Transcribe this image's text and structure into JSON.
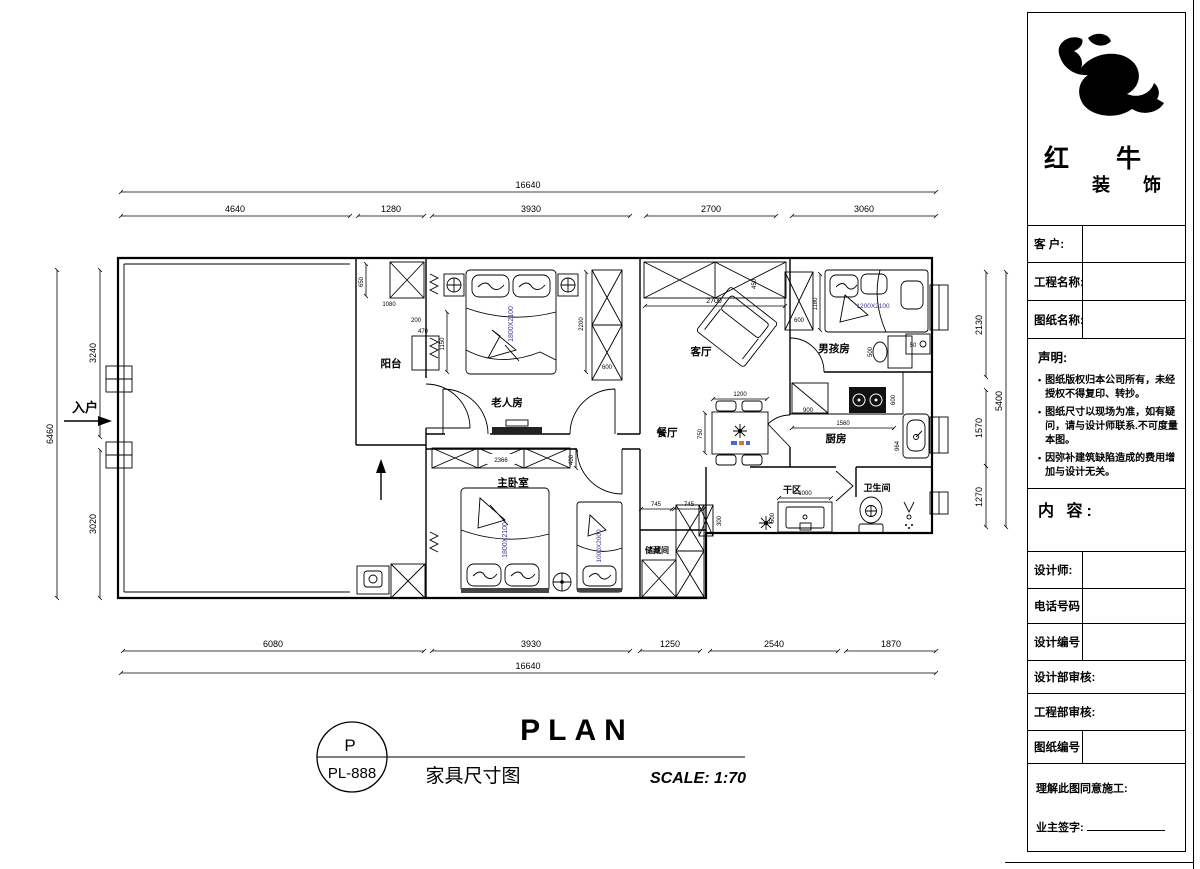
{
  "title_bar": {
    "plan_title": "PLAN",
    "drawing_letter": "P",
    "drawing_code": "PL-888",
    "drawing_name": "家具尺寸图",
    "scale": "SCALE: 1:70"
  },
  "title_block": {
    "brand_line1": "红 牛",
    "brand_line2": "装 饰",
    "info_rows": [
      {
        "label": "客 户:"
      },
      {
        "label": "工程名称:"
      },
      {
        "label": "图纸名称:"
      }
    ],
    "statement": {
      "heading": "声明:",
      "items": [
        "图纸版权归本公司所有，未经授权不得复印、转抄。",
        "图纸尺寸以现场为准，如有疑问，请与设计师联系.不可度量本图。",
        "因弥补建筑缺陷造成的费用增加与设计无关。"
      ]
    },
    "content_heading": "内 容:",
    "detail_rows": [
      {
        "label": "设计师:"
      },
      {
        "label": "电话号码"
      },
      {
        "label": "设计编号"
      },
      {
        "label": "设计部审核:"
      },
      {
        "label": "工程部审核:"
      },
      {
        "label": "图纸编号"
      }
    ],
    "footer": {
      "agree": "理解此图同意施工:",
      "sign": "业主签字:"
    }
  },
  "plan": {
    "rooms": {
      "balcony": "阳台",
      "elder": "老人房",
      "living": "客厅",
      "dining": "餐厅",
      "boy": "男孩房",
      "kitchen": "厨房",
      "master": "主卧室",
      "storage": "储藏间",
      "dry": "干区",
      "bath": "卫生间"
    },
    "entry": "入户",
    "beds": {
      "elder": "1800X2100",
      "master": "1800X2100",
      "single": "1000X2000",
      "boy": "1200X2100"
    },
    "water_heater": "50",
    "dims": {
      "top_overall": "16640",
      "top": [
        "4640",
        "1280",
        "3930",
        "2700",
        "3060"
      ],
      "bottom": [
        "6080",
        "3930",
        "1250",
        "2540",
        "1870"
      ],
      "bottom_overall": "16640",
      "left": [
        "3240",
        "3020"
      ],
      "left_overall": "6460",
      "right": [
        "2130",
        "1570",
        "1270"
      ],
      "right_overall": "5400",
      "interior": {
        "balcony_650": "650",
        "balcony_1080": "1080",
        "w200": "200",
        "w470": "470",
        "elder_1150": "1150",
        "elder_2200": "2200",
        "elder_ward_600": "600",
        "tv_2366": "2366",
        "master_400": "400",
        "living_2700": "2700",
        "living_450": "450",
        "dining_1200": "1200",
        "dining_750": "750",
        "boy_1180": "1180",
        "boy_ward_600": "600",
        "boy_desk_500": "500",
        "kitchen_900": "900",
        "kitchen_1560": "1560",
        "kitchen_600": "600",
        "kitchen_964": "964",
        "storage_745a": "745",
        "storage_745b": "745",
        "dry_1000": "1000",
        "dry_500": "500",
        "dry_300": "300"
      }
    }
  }
}
